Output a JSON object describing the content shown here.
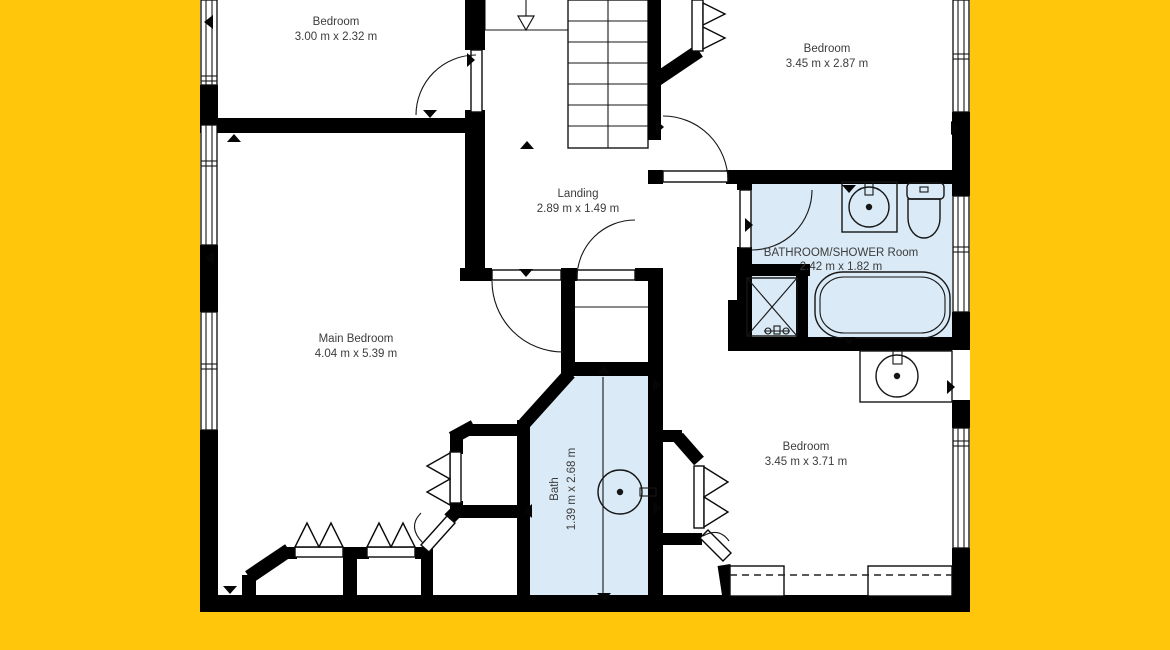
{
  "colors": {
    "background": "#FFC60B",
    "wet_room_fill": "#DAEAF6",
    "wall": "#000000",
    "label_text": "#3C3C3C",
    "plan_background": "#FFFFFF"
  },
  "rooms": [
    {
      "name": "Bedroom",
      "dims": "3.00 m x 2.32 m"
    },
    {
      "name": "Bedroom",
      "dims": "3.45 m x 2.87 m"
    },
    {
      "name": "Landing",
      "dims": "2.89 m x 1.49 m"
    },
    {
      "name": "BATHROOM/SHOWER Room",
      "dims": "2.42 m x 1.82 m"
    },
    {
      "name": "Main Bedroom",
      "dims": "4.04 m x 5.39 m"
    },
    {
      "name": "Bath",
      "dims": "1.39 m x 2.68 m"
    },
    {
      "name": "Bedroom",
      "dims": "3.45 m x 3.71 m"
    }
  ]
}
